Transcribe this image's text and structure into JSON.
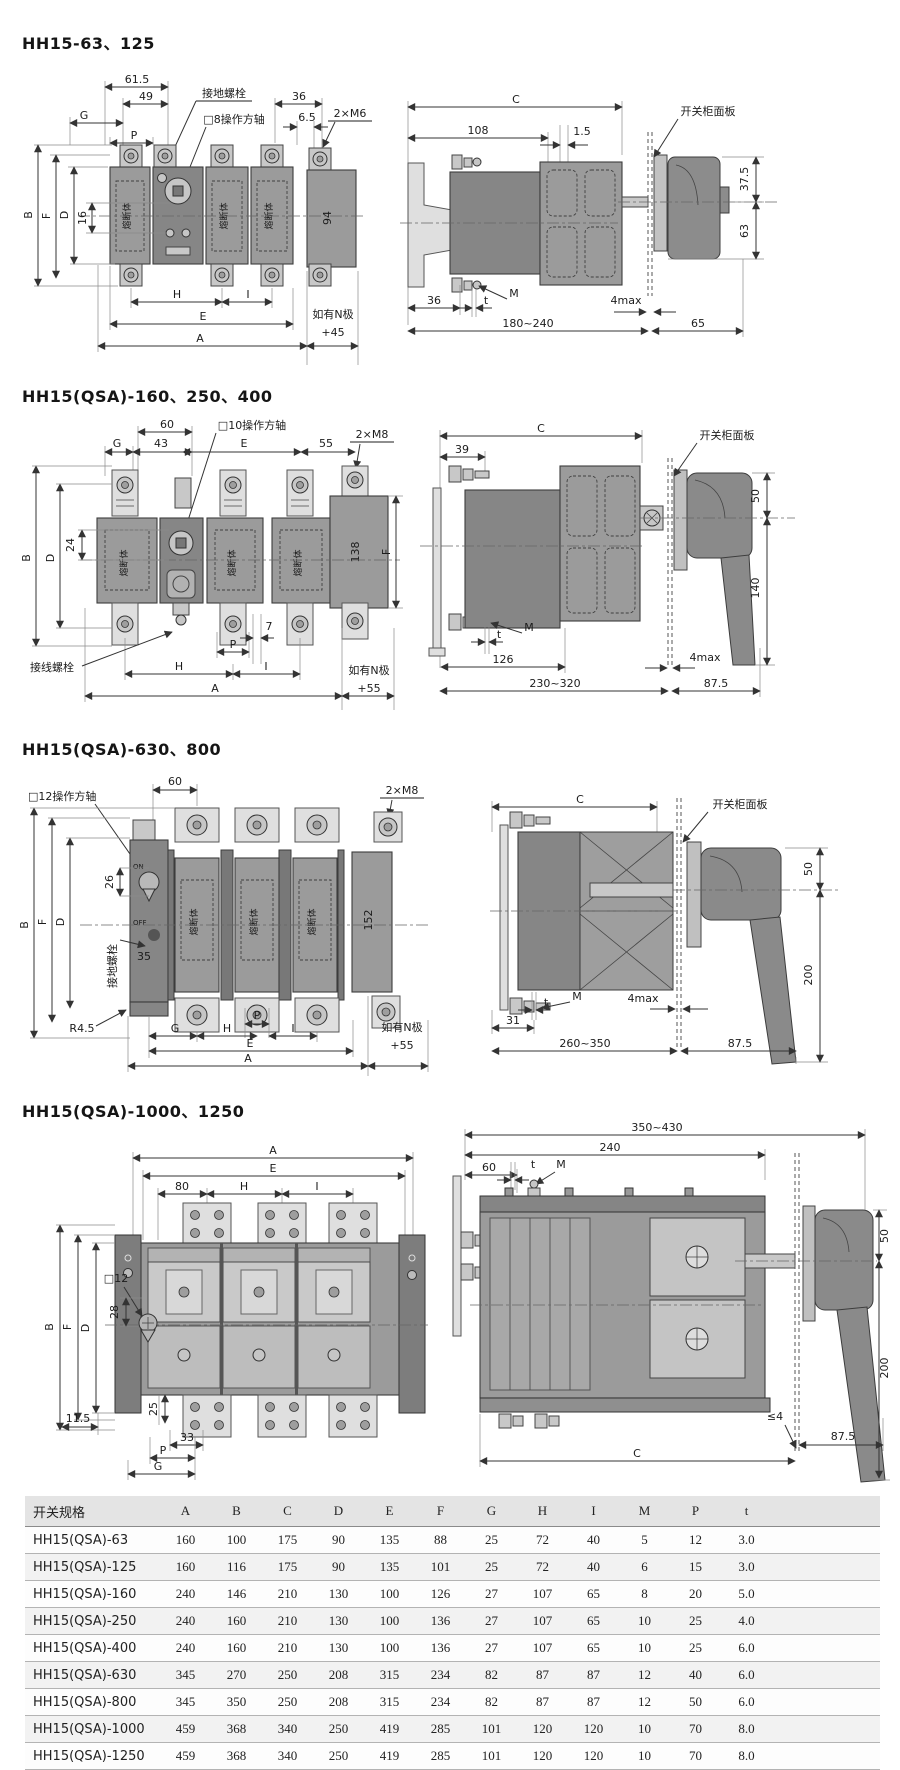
{
  "colors": {
    "line": "#3c3c3c",
    "body_gray": "#9b9b9b",
    "mech_gray": "#868686",
    "pad_gray": "#dfdfdf",
    "table_header_bg": "#e4e4e4"
  },
  "sections": [
    {
      "title": "HH15-63、125",
      "front": {
        "w615": "61.5",
        "w49": "49",
        "g": "G",
        "p": "P",
        "ground": "接地螺栓",
        "shaft": "□8操作方轴",
        "w36": "36",
        "w65": "6.5",
        "bolts": "2×M6",
        "b": "B",
        "f": "F",
        "d": "D",
        "h16": "16",
        "fuse": "熔断体",
        "n94": "94",
        "h": "H",
        "i": "I",
        "e": "E",
        "a": "A",
        "note1": "如有N极",
        "note2": "+45"
      },
      "side": {
        "c": "C",
        "w108": "108",
        "w15": "1.5",
        "panel": "开关柜面板",
        "h375": "37.5",
        "h63": "63",
        "w36": "36",
        "t": "t",
        "m": "M",
        "gap": "4max",
        "depth": "180~240",
        "w65": "65"
      }
    },
    {
      "title": "HH15(QSA)-160、250、400",
      "front": {
        "w60": "60",
        "w43": "43",
        "g": "G",
        "shaft": "□10操作方轴",
        "e": "E",
        "w55": "55",
        "bolts": "2×M8",
        "b": "B",
        "d": "D",
        "h24": "24",
        "f": "F",
        "n138": "138",
        "fuse": "熔断体",
        "wiring": "接线螺栓",
        "p": "P",
        "w7": "7",
        "h": "H",
        "i": "I",
        "a": "A",
        "note1": "如有N极",
        "note2": "+55"
      },
      "side": {
        "c": "C",
        "w39": "39",
        "panel": "开关柜面板",
        "h50": "50",
        "h140": "140",
        "m": "M",
        "t": "t",
        "w126": "126",
        "gap": "4max",
        "depth": "230~320",
        "w875": "87.5"
      }
    },
    {
      "title": "HH15(QSA)-630、800",
      "front": {
        "shaft": "□12操作方轴",
        "w60": "60",
        "bolts": "2×M8",
        "b": "B",
        "f": "F",
        "d": "D",
        "h26": "26",
        "h35": "35",
        "ground": "接地螺栓",
        "on": "ON",
        "off": "OFF",
        "n152": "152",
        "fuse": "熔断体",
        "r45": "R4.5",
        "g": "G",
        "h": "H",
        "p": "P",
        "i": "I",
        "e": "E",
        "a": "A",
        "note1": "如有N极",
        "note2": "+55"
      },
      "side": {
        "c": "C",
        "panel": "开关柜面板",
        "h50": "50",
        "h200": "200",
        "m": "M",
        "t": "t",
        "w31": "31",
        "gap": "4max",
        "depth": "260~350",
        "w875": "87.5"
      }
    },
    {
      "title": "HH15(QSA)-1000、1250",
      "front": {
        "a": "A",
        "e": "E",
        "w80": "80",
        "h": "H",
        "i": "I",
        "shaft": "□12",
        "h28": "28",
        "b": "B",
        "f": "F",
        "d": "D",
        "w115": "11.5",
        "h25": "25",
        "w33": "33",
        "p": "P",
        "g": "G"
      },
      "side": {
        "depth": "350~430",
        "w240": "240",
        "w60": "60",
        "t": "t",
        "m": "M",
        "h50": "50",
        "h200": "200",
        "gap": "≤4",
        "w875": "87.5",
        "c": "C"
      }
    }
  ],
  "table": {
    "headers": [
      "开关规格",
      "A",
      "B",
      "C",
      "D",
      "E",
      "F",
      "G",
      "H",
      "I",
      "M",
      "P",
      "t"
    ],
    "rows": [
      [
        "HH15(QSA)-63",
        "160",
        "100",
        "175",
        "90",
        "135",
        "88",
        "25",
        "72",
        "40",
        "5",
        "12",
        "3.0"
      ],
      [
        "HH15(QSA)-125",
        "160",
        "116",
        "175",
        "90",
        "135",
        "101",
        "25",
        "72",
        "40",
        "6",
        "15",
        "3.0"
      ],
      [
        "HH15(QSA)-160",
        "240",
        "146",
        "210",
        "130",
        "100",
        "126",
        "27",
        "107",
        "65",
        "8",
        "20",
        "5.0"
      ],
      [
        "HH15(QSA)-250",
        "240",
        "160",
        "210",
        "130",
        "100",
        "136",
        "27",
        "107",
        "65",
        "10",
        "25",
        "4.0"
      ],
      [
        "HH15(QSA)-400",
        "240",
        "160",
        "210",
        "130",
        "100",
        "136",
        "27",
        "107",
        "65",
        "10",
        "25",
        "6.0"
      ],
      [
        "HH15(QSA)-630",
        "345",
        "270",
        "250",
        "208",
        "315",
        "234",
        "82",
        "87",
        "87",
        "12",
        "40",
        "6.0"
      ],
      [
        "HH15(QSA)-800",
        "345",
        "350",
        "250",
        "208",
        "315",
        "234",
        "82",
        "87",
        "87",
        "12",
        "50",
        "6.0"
      ],
      [
        "HH15(QSA)-1000",
        "459",
        "368",
        "340",
        "250",
        "419",
        "285",
        "101",
        "120",
        "120",
        "10",
        "70",
        "8.0"
      ],
      [
        "HH15(QSA)-1250",
        "459",
        "368",
        "340",
        "250",
        "419",
        "285",
        "101",
        "120",
        "120",
        "10",
        "70",
        "8.0"
      ]
    ]
  }
}
